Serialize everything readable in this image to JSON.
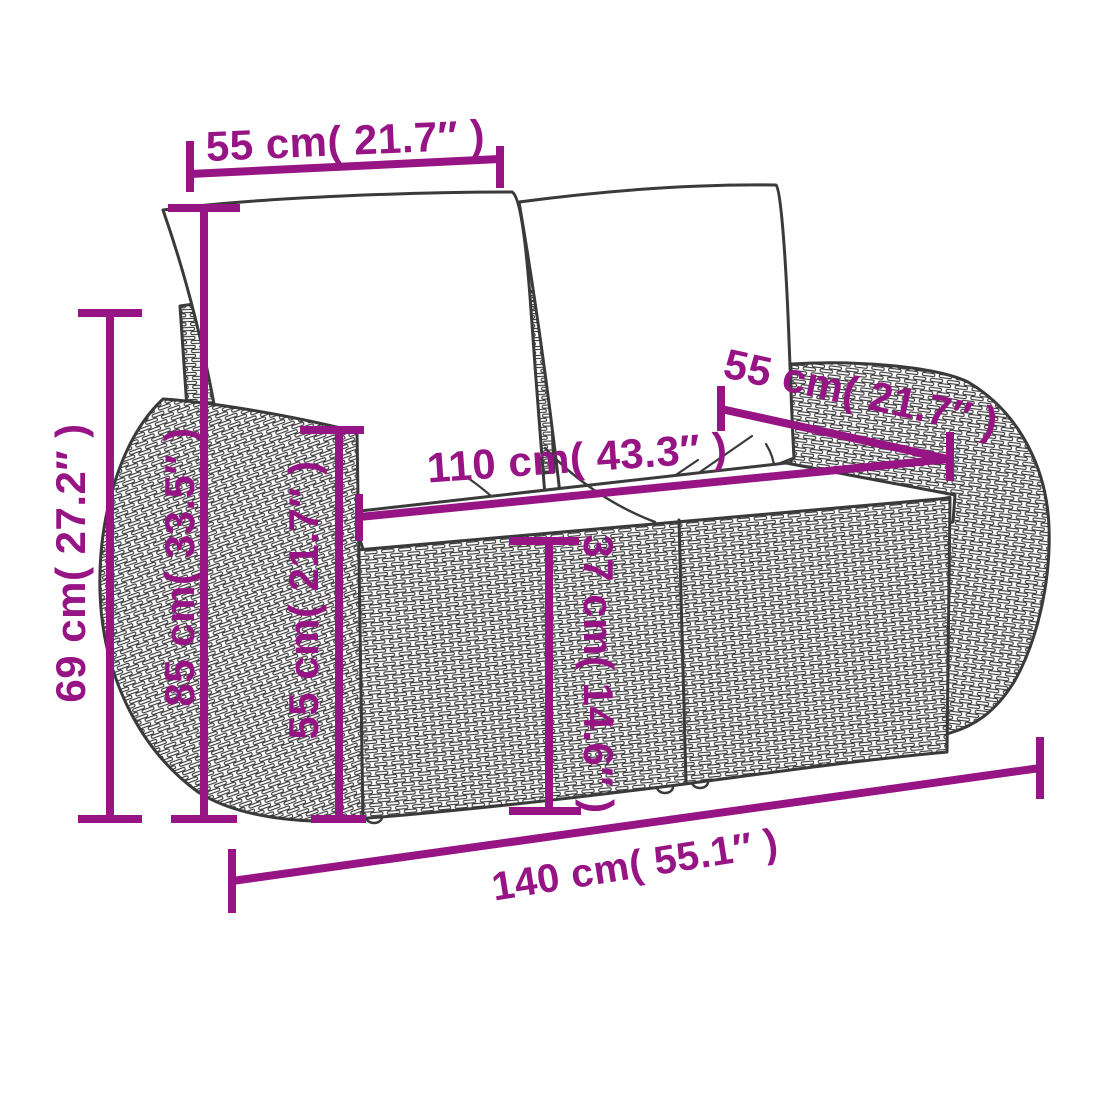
{
  "diagram": {
    "accent_color": "#971485",
    "outline_color": "#3a3a3a",
    "background_color": "#ffffff"
  },
  "dimensions": {
    "backrest_width": {
      "label": "55 cm( 21.7″ )"
    },
    "back_height": {
      "label": "85 cm( 33.5″ )"
    },
    "side_height": {
      "label": "69 cm( 27.2″ )"
    },
    "armrest_height": {
      "label": "55 cm( 21.7″ )"
    },
    "seat_width": {
      "label": "110 cm( 43.3″ )"
    },
    "seat_depth": {
      "label": "55 cm( 21.7″ )"
    },
    "seat_height": {
      "label": "37 cm( 14.6″ )"
    },
    "total_width": {
      "label": "140 cm( 55.1″ )"
    }
  }
}
